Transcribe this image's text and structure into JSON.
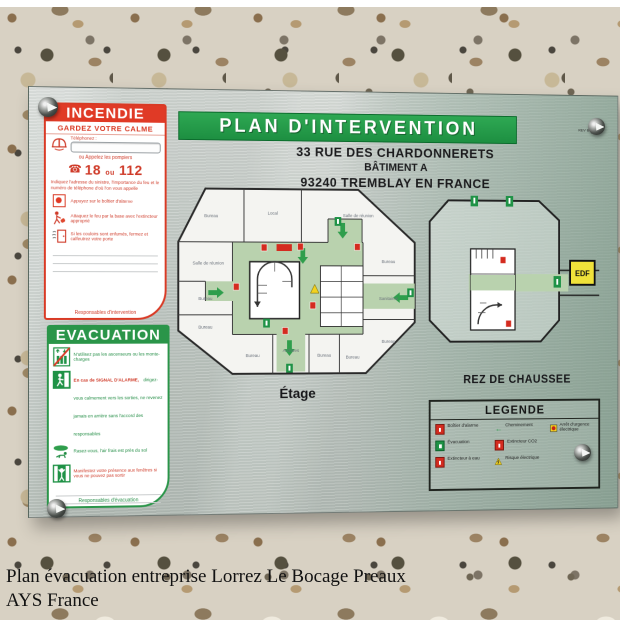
{
  "page": {
    "caption_line1": "Plan évacuation entreprise Lorrez Le Bocage Preaux",
    "caption_line2": "AYS France"
  },
  "sign": {
    "title": "PLAN D'INTERVENTION",
    "revision_note": "REV B",
    "address": {
      "line1": "33 RUE DES CHARDONNERETS",
      "line2": "BÂTIMENT A",
      "line3": "93240 TREMBLAY EN FRANCE"
    },
    "colors": {
      "banner_green": "#1f9246",
      "alert_red": "#d93a25",
      "corridor_green": "#b9d2ae",
      "metal_grey": "#c3cac5",
      "metal_green_tint": "#93ab9d",
      "edf_yellow": "#f0e23a"
    },
    "incendie": {
      "header": "INCENDIE",
      "keep_calm": "GARDEZ VOTRE CALME",
      "phone_label": "Téléphonez :",
      "phone_value": "",
      "or_call": "ou Appelez les pompiers",
      "numbers": {
        "n1": "18",
        "sep": "ou",
        "n2": "112"
      },
      "call_instructions": "Indiquez l'adresse du sinistre, l'importance du feu et le numéro de téléphone d'où l'on vous appelle",
      "steps": [
        {
          "icon": "alarm-button-icon",
          "text": "Appuyez sur le boîtier d'alarme"
        },
        {
          "icon": "extinguisher-person-icon",
          "text": "Attaquez le feu par la base avec l'extincteur approprié"
        },
        {
          "icon": "smoke-door-icon",
          "text": "Si les couloirs sont enfumés, fermez et calfeutrez votre porte"
        }
      ],
      "footer": "Responsables d'intervention"
    },
    "evacuation": {
      "header": "EVACUATION",
      "steps": [
        {
          "icon": "no-elevator-icon",
          "text": "N'utilisez pas les ascenseurs ou les monte-charges"
        },
        {
          "icon": "exit-man-icon",
          "text_red": "En cas de SIGNAL D'ALARME,",
          "text": "dirigez-vous calmement vers les sorties, ne revenez jamais en arrière sans l'accord des responsables"
        },
        {
          "icon": "crawl-icon",
          "text": "Rasez-vous, l'air frais est près du sol"
        },
        {
          "icon": "assembly-icon",
          "text": "Manifestez votre présence aux fenêtres si vous ne pouvez pas sortir"
        }
      ],
      "footer": "Responsables d'évacuation"
    },
    "plans": {
      "etage": {
        "label": "Étage",
        "rooms": [
          "Bureau",
          "Local",
          "Salle de réunion",
          "Salle de réunion",
          "Bureau",
          "Bureau",
          "Bureau",
          "Archives",
          "Bureau",
          "Bureau",
          "Bureau",
          "Sanitaires",
          "Bureau"
        ]
      },
      "rdc": {
        "label": "REZ DE CHAUSSEE",
        "edf_label": "EDF"
      }
    },
    "legend": {
      "title": "LEGENDE",
      "items": [
        {
          "icon": "alarm-box-icon",
          "label": "Boîtier d'alarme"
        },
        {
          "icon": "evacuation-icon",
          "label": "Évacuation"
        },
        {
          "icon": "water-extinguisher-icon",
          "label": "Extincteur à eau"
        },
        {
          "icon": "route-arrow-icon",
          "label": "Cheminement"
        },
        {
          "icon": "co2-extinguisher-icon",
          "label": "Extincteur CO2"
        },
        {
          "icon": "electric-hazard-icon",
          "label": "Risque électrique"
        },
        {
          "icon": "emergency-stop-icon",
          "label": "Arrêt d'urgence électrique"
        }
      ]
    }
  }
}
